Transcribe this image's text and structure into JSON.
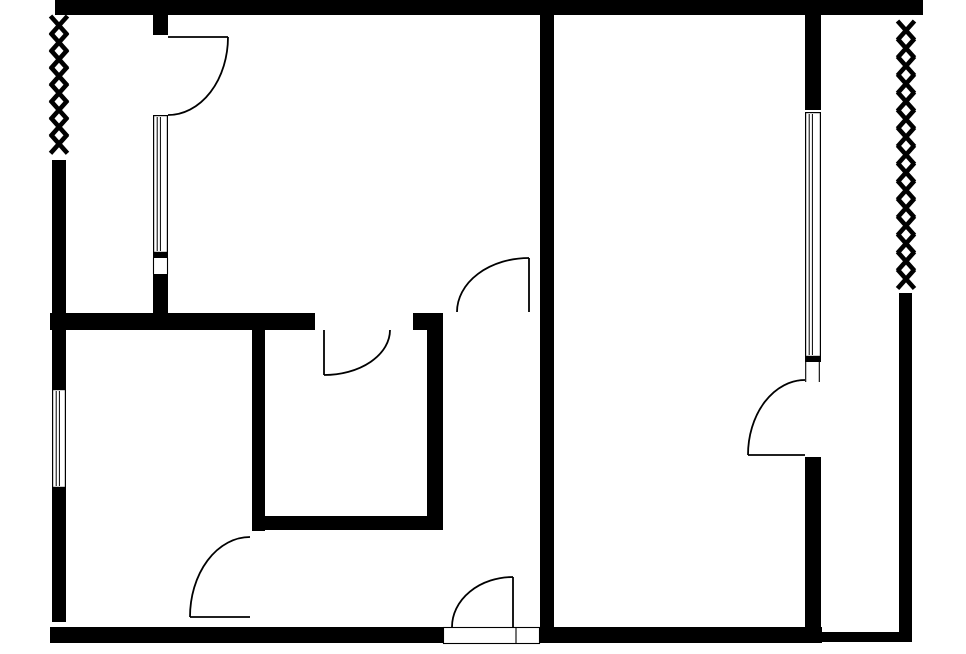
{
  "canvas": {
    "width": 966,
    "height": 654,
    "background_color": "#ffffff",
    "ink_color": "#000000",
    "title": "apartment-floor-plan"
  },
  "plan": {
    "stroke_widths": {
      "door": 1.8,
      "thin": 1.1,
      "fence": 4.6,
      "window_frame": 1.2,
      "window_pane": 1
    },
    "walls": [
      {
        "name": "wall-top",
        "x": 55,
        "y": 0,
        "w": 868,
        "h": 15
      },
      {
        "name": "wall-central",
        "x": 540,
        "y": 15,
        "w": 14,
        "h": 612
      },
      {
        "name": "wall-stub-upper-left-door",
        "x": 153,
        "y": 15,
        "w": 15,
        "h": 20
      },
      {
        "name": "wall-left-upper",
        "x": 52,
        "y": 160,
        "w": 14,
        "h": 229
      },
      {
        "name": "wall-left-mid-segment",
        "x": 153,
        "y": 274,
        "w": 15,
        "h": 40
      },
      {
        "name": "wall-interior-horizontal",
        "x": 50,
        "y": 313,
        "w": 265,
        "h": 17
      },
      {
        "name": "wall-interior-horizontal-stub",
        "x": 413,
        "y": 313,
        "w": 30,
        "h": 17
      },
      {
        "name": "wall-inner-room-left",
        "x": 252,
        "y": 329,
        "w": 13,
        "h": 202
      },
      {
        "name": "wall-inner-room-right",
        "x": 427,
        "y": 314,
        "w": 16,
        "h": 216
      },
      {
        "name": "wall-inner-room-bottom",
        "x": 252,
        "y": 516,
        "w": 191,
        "h": 14
      },
      {
        "name": "wall-left-lower",
        "x": 52,
        "y": 488,
        "w": 14,
        "h": 134
      },
      {
        "name": "wall-bottom-left",
        "x": 50,
        "y": 627,
        "w": 393,
        "h": 16
      },
      {
        "name": "wall-bottom-right",
        "x": 540,
        "y": 627,
        "w": 282,
        "h": 16
      },
      {
        "name": "wall-right-room-upper",
        "x": 805,
        "y": 15,
        "w": 16,
        "h": 95
      },
      {
        "name": "wall-right-room-lower",
        "x": 805,
        "y": 457,
        "w": 16,
        "h": 175
      },
      {
        "name": "wall-balcony-bottom",
        "x": 821,
        "y": 632,
        "w": 91,
        "h": 10
      },
      {
        "name": "wall-right-outer",
        "x": 899,
        "y": 293,
        "w": 13,
        "h": 349
      },
      {
        "name": "window-upper-left-bottom-cap",
        "x": 153,
        "y": 253,
        "w": 15,
        "h": 5
      },
      {
        "name": "window-right-bottom-cap",
        "x": 805,
        "y": 357,
        "w": 16,
        "h": 5
      }
    ],
    "windows": [
      {
        "name": "window-upper-left-wall",
        "x": 153,
        "y": 115,
        "w": 15,
        "h": 138
      },
      {
        "name": "window-left-outer-wall",
        "x": 52,
        "y": 389,
        "w": 14,
        "h": 99
      },
      {
        "name": "window-right-wall",
        "x": 805,
        "y": 112,
        "w": 16,
        "h": 245
      }
    ],
    "doors": [
      {
        "name": "door-upper-left",
        "leaf": [
          168,
          37,
          228,
          37
        ],
        "arc": "M228,37 A60,78 0 0 1 168,115"
      },
      {
        "name": "door-inner-room",
        "leaf": [
          324,
          330,
          324,
          375
        ],
        "arc": "M324,375 A66,45 0 0 0 390,330"
      },
      {
        "name": "door-hall-to-upper-room",
        "leaf": [
          529,
          258,
          529,
          312
        ],
        "arc": "M529,258 A72,54 0 0 0 457,312"
      },
      {
        "name": "door-right-room-balcony",
        "leaf": [
          748,
          455,
          805,
          455
        ],
        "arc": "M748,455 A57,75 0 0 1 805,380"
      },
      {
        "name": "door-lower-left-room",
        "leaf": [
          190,
          617,
          250,
          617
        ],
        "arc": "M190,617 A60,80 0 0 1 250,537"
      },
      {
        "name": "door-entry",
        "leaf": [
          513,
          577,
          513,
          627
        ],
        "arc": "M513,577 A61,50 0 0 0 452,627"
      }
    ],
    "thin_lines": [
      {
        "name": "jamb-left-gap-outer",
        "x1": 153.5,
        "y1": 258,
        "x2": 153.5,
        "y2": 274
      },
      {
        "name": "jamb-left-gap-inner",
        "x1": 167.5,
        "y1": 258,
        "x2": 167.5,
        "y2": 274
      },
      {
        "name": "jamb-right-door-outer",
        "x1": 805.7,
        "y1": 362,
        "x2": 805.7,
        "y2": 382
      },
      {
        "name": "jamb-right-door-inner",
        "x1": 819.3,
        "y1": 362,
        "x2": 819.3,
        "y2": 382
      }
    ],
    "threshold": {
      "name": "entry-threshold",
      "x": 443,
      "y": 627,
      "w": 97,
      "h": 17,
      "divider_x": 516
    },
    "fences": [
      {
        "name": "fence-left",
        "cx": 59,
        "y_top": 16,
        "count": 8,
        "step": 16.9,
        "half_w": 8.5,
        "half_h": 9.5
      },
      {
        "name": "fence-right",
        "cx": 906,
        "y_top": 21,
        "count": 15,
        "step": 17.75,
        "half_w": 8.5,
        "half_h": 9.5
      }
    ]
  }
}
